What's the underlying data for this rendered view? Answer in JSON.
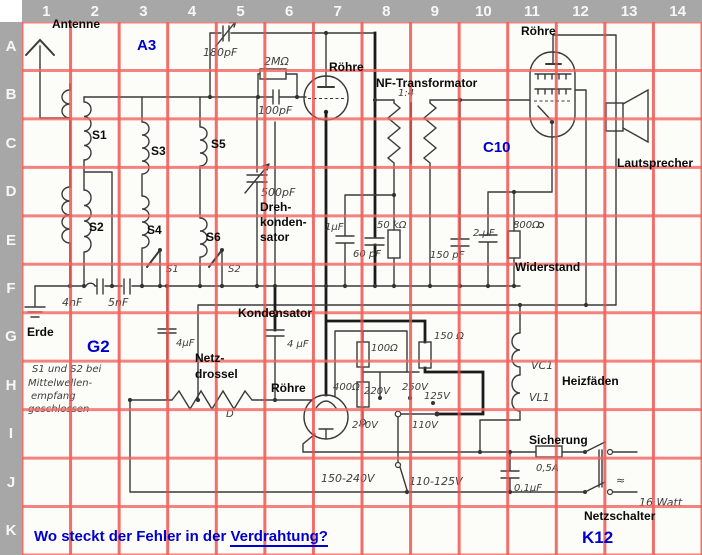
{
  "grid": {
    "columns": [
      "1",
      "2",
      "3",
      "4",
      "5",
      "6",
      "7",
      "8",
      "9",
      "10",
      "11",
      "12",
      "13",
      "14"
    ],
    "rows": [
      "A",
      "B",
      "C",
      "D",
      "E",
      "F",
      "G",
      "H",
      "I",
      "J",
      "K"
    ],
    "line_color_v": "#ec4c48",
    "line_color_h": "#f06660",
    "header_bg": "#a7a7a7",
    "header_text_color": "#f7f7f7",
    "paper_color": "#fcfcf8",
    "ink_color": "#3a3a3a"
  },
  "overlay": {
    "color": "#0000cd",
    "a3": "A3",
    "c10": "C10",
    "g2": "G2",
    "k12": "K12",
    "question_prefix": "Wo steckt der Fehler in der ",
    "question_highlight": "Verdrahtung?"
  },
  "labels": {
    "antenne": "Antenne",
    "roehre_rf": "Röhre",
    "nf_transformator": "NF-Transformator",
    "roehre_out": "Röhre",
    "lautsprecher": "Lautsprecher",
    "s1": "S1",
    "s2": "S2",
    "s3": "S3",
    "s4": "S4",
    "s5": "S5",
    "s6": "S6",
    "dreh_1": "Dreh-",
    "dreh_2": "konden-",
    "dreh_3": "sator",
    "kondensator": "Kondensator",
    "netz_1": "Netz-",
    "netz_2": "drossel",
    "roehre_ps": "Röhre",
    "widerstand": "Widerstand",
    "heizfaeden": "Heizfäden",
    "sicherung": "Sicherung",
    "netzschalter": "Netzschalter",
    "erde": "Erde"
  },
  "hw": {
    "c180": "180pF",
    "r2m": "2MΩ",
    "c100": "100pF",
    "ratio": "1:4",
    "c500": "500pF",
    "sw_s1": "S1",
    "sw_s2": "S2",
    "c4n": "4nF",
    "c5n": "5nF",
    "c1u": "1μF",
    "r50k": "50 kΩ",
    "c60": "60 pF",
    "c150": "150 pF",
    "c2u": "2 μF",
    "r800": "800Ω",
    "c4u_g": "4μF",
    "c4u_k": "4 μF",
    "r100": "100Ω",
    "r150": "150 Ω",
    "r400": "400Ω",
    "v220": "220V",
    "v250": "250V",
    "v125": "125V",
    "v240": "240V",
    "v110": "110V",
    "range_high": "150-240V",
    "range_low": "110-125V",
    "fuse": "0,5A",
    "c01": "0,1μF",
    "watt": "16 Watt",
    "d": "D",
    "vc1": "VC1",
    "vl1": "VL1",
    "ac": "≈",
    "note_1": "S1 und S2 bei",
    "note_2": "Mittelwellen-",
    "note_3": "empfang",
    "note_4": "geschlossen"
  }
}
